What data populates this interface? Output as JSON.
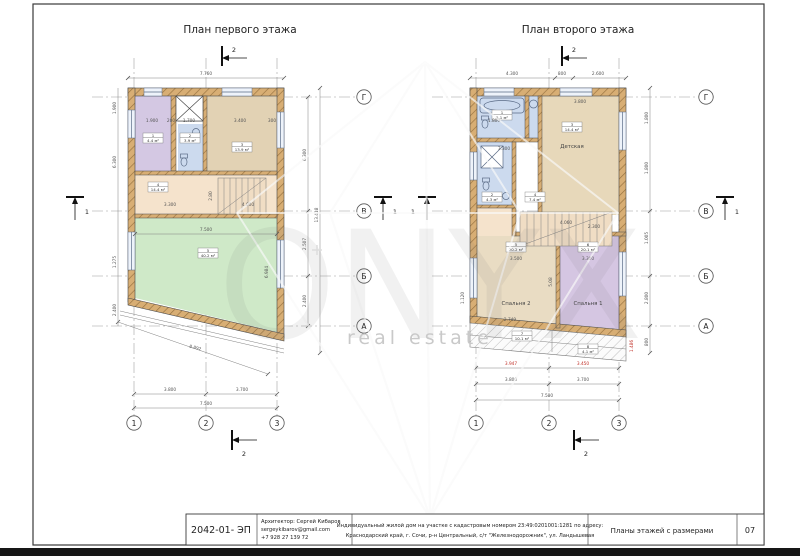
{
  "sheet": {
    "plan1_title": "План первого этажа",
    "plan2_title": "План второго этажа",
    "watermark": {
      "brand": "ONYX",
      "sub": "real estate"
    },
    "titleblock": {
      "code": "2042-01- ЭП",
      "architect": "Архитектор: Сергей Кибаров",
      "email": "sergeykibarov@gmail.com",
      "phone": "+7 928 27 139 72",
      "desc1": "Индивидуальный жилой дом на участке с кадастровым номером 23:49:0201001:1281 по адресу:",
      "desc2": "Краснодарский край, г. Сочи, р-н Центральный, с/т \"Железнодорожник\", ул. Ландышевая",
      "sheet_title": "Планы этажей с размерами",
      "page_num": "07"
    }
  },
  "plan1": {
    "axis_cols": [
      "1",
      "2",
      "3"
    ],
    "axis_rows": [
      "Г",
      "В",
      "Б",
      "А"
    ],
    "section_top": "2",
    "section_bottom": "2",
    "section_left": "1",
    "section_right": "1",
    "dims": {
      "top_total": "7.760",
      "inner_top": [
        "1.900",
        "200",
        "1.700",
        "3.400",
        "300"
      ],
      "hall_w1": "3.300",
      "hall_w2": "4.000",
      "hall_h": "2.80",
      "green_w": "7.500",
      "green_h": "6.984",
      "bottom": [
        "3.800",
        "3.700"
      ],
      "bottom_total": "7.500",
      "right": [
        "6.300",
        "2.507",
        "2.400"
      ],
      "right_total": "13.418",
      "left": [
        "1.900",
        "6.300",
        "1.275",
        "2.400"
      ],
      "diag": "8.892"
    },
    "rooms": {
      "r1_num": "1",
      "r1_area": "4.4 м²",
      "r2_num": "2",
      "r2_area": "3.9 м²",
      "r3_num": "3",
      "r3_area": "13.9 м²",
      "r4_num": "4",
      "r4_area": "14.4 м²",
      "r5_num": "5",
      "r5_area": "40.2 м²"
    }
  },
  "plan2": {
    "axis_cols": [
      "1",
      "2",
      "3"
    ],
    "axis_rows": [
      "Г",
      "В",
      "Б",
      "А"
    ],
    "section_top": "2",
    "section_bottom": "2",
    "section_left": "1",
    "section_right": "1",
    "dims": {
      "top": [
        "4.300",
        "800",
        "2.600"
      ],
      "child_w": "3.800",
      "bath_a": "1.800",
      "bath_b": "3.300",
      "stairs": "4.060",
      "bed2_w": "3.500",
      "bed1_w": "3.300",
      "bed1_t": "2.300",
      "mid_h": "5.08",
      "balcony": "2.749",
      "left_h": "1.120",
      "red_a": "3.947",
      "red_b": "3.450",
      "red_side": "1.486",
      "bottom": [
        "3.800",
        "3.700"
      ],
      "bottom_total": "7.500",
      "right": [
        "1.800",
        "1.800",
        "1.005",
        "2.800",
        "800"
      ]
    },
    "rooms": {
      "bath_num": "1",
      "bath_area": "5.1 м²",
      "shower_num": "2",
      "shower_area": "4.3 м²",
      "child_num": "3",
      "child_area": "14.4 м²",
      "child_name": "Детская",
      "hall_num": "4",
      "hall_area": "7.4 м²",
      "bed2_num": "5",
      "bed2_area": "20.2 м²",
      "bed2_name": "Спальня 2",
      "bed1_num": "6",
      "bed1_area": "20.1 м²",
      "bed1_name": "Спальня 1",
      "balc1_num": "7",
      "balc1_area": "10.1 м²",
      "balc2_num": "8",
      "balc2_area": "4.1 м²"
    }
  }
}
